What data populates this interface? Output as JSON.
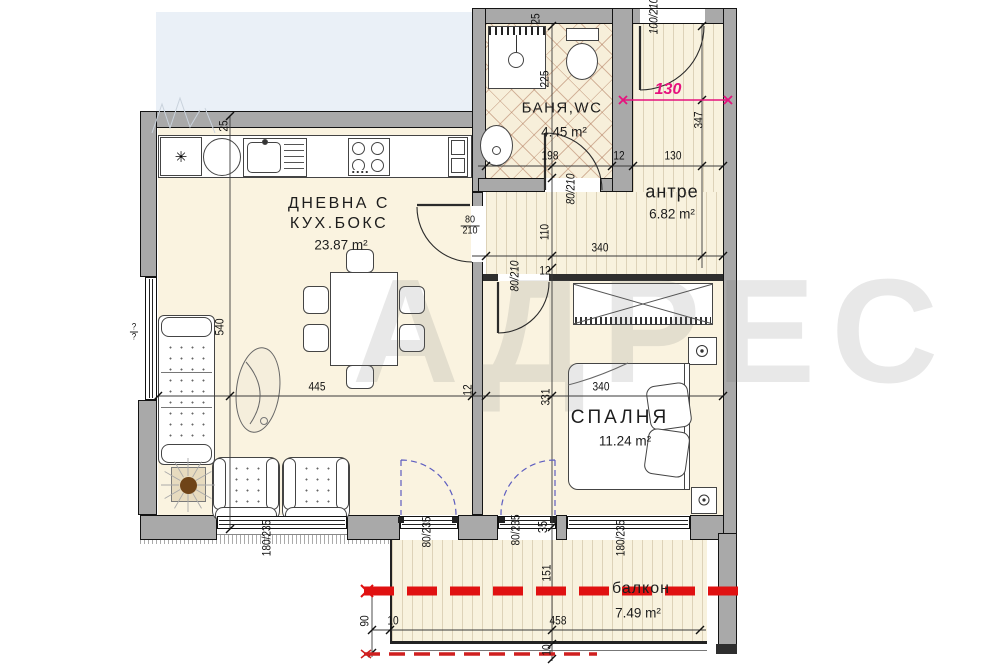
{
  "watermark": "АДРЕС",
  "rooms": {
    "living": {
      "name_line1": "ДНЕВНА С",
      "name_line2": "КУХ.БОКС",
      "area": "23.87 m²"
    },
    "bathroom": {
      "name": "БАНЯ,WC",
      "area": "4.45 m²"
    },
    "hallway": {
      "name": "антре",
      "area": "6.82 m²"
    },
    "bedroom": {
      "name": "СПАЛНЯ",
      "area": "11.24 m²"
    },
    "balcony": {
      "name": "балкон",
      "area": "7.49 m²"
    }
  },
  "icons": {
    "washer": "✳"
  },
  "labels": {
    "kitchen_wall": "25",
    "living_w": "540",
    "living_l": "445",
    "wall12_living": "12",
    "window_left_top": "?",
    "window_left_bot": "?",
    "win_a": "180/235",
    "door_a": "80/235",
    "door_b": "80/235",
    "d35": "35",
    "win_b": "180/235",
    "balc_h": "90",
    "balc_10a": "10",
    "balc_len": "458",
    "balc_10b": "10",
    "balc_w": "151",
    "bath_tub": "225",
    "bath_wall": "25",
    "bath_w": "198",
    "wall12_bath": "12",
    "hall_w": "130",
    "entry_door": "100/210",
    "pink_130": "130",
    "hall_h": "347",
    "bath_door": "80/210",
    "cor_w": "110",
    "cor_len": "340",
    "liv_door_top": "80",
    "liv_door_bot": "210",
    "bed_door": "80/210",
    "wall12_bed": "12",
    "bed_h": "331",
    "bed_w": "340"
  },
  "colors": {
    "accent_red": "#e01111",
    "accent_pink": "#e6127d",
    "door_swing_blue": "#5d5dc0",
    "wall_gray": "#a9a9a9",
    "floor_beige": "#faf3e0"
  }
}
